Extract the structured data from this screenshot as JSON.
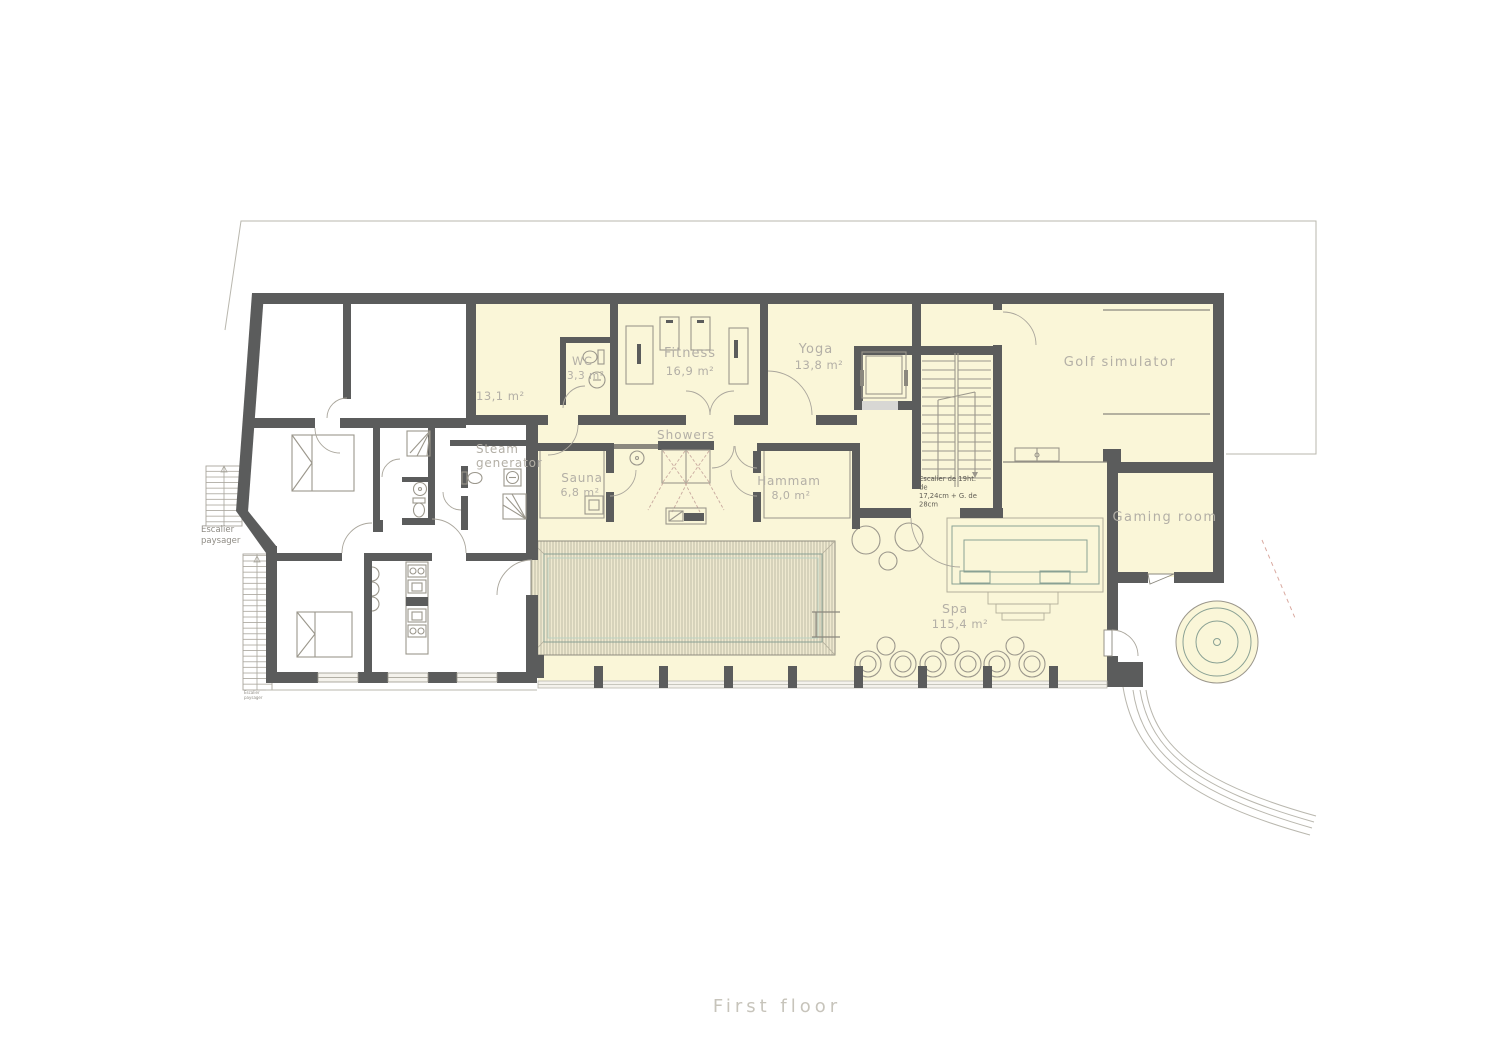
{
  "title": "First floor",
  "rooms": {
    "room131": {
      "area": "13,1 m²"
    },
    "wc": {
      "name": "WC",
      "area": "3,3 m²"
    },
    "fitness": {
      "name": "Fitness",
      "area": "16,9 m²"
    },
    "yoga": {
      "name": "Yoga",
      "area": "13,8 m²"
    },
    "golf": {
      "name": "Golf simulator"
    },
    "showers": {
      "name": "Showers"
    },
    "sauna": {
      "name": "Sauna",
      "area": "6,8 m²"
    },
    "hammam": {
      "name": "Hammam",
      "area": "8,0 m²"
    },
    "steam_generator": {
      "line1": "Steam",
      "line2": "generator"
    },
    "gaming": {
      "name": "Gaming room"
    },
    "spa": {
      "name": "Spa",
      "area": "115,4 m²"
    }
  },
  "annotations": {
    "stair_note_line1": "Escalier de 19ht.",
    "stair_note_line2": "de",
    "stair_note_line3": "17,24cm + G. de",
    "stair_note_line4": "28cm",
    "landscape_stair": {
      "line1": "Escalier",
      "line2": "paysager"
    },
    "landscape_stair_small": {
      "line1": "Escalier",
      "line2": "paysager"
    }
  },
  "colors": {
    "wall": "#5b5c5c",
    "room_fill": "#faf6d8",
    "pool_water": "#cfe8da",
    "pool_deck": "#efe9d0",
    "label_text": "#b3afa6",
    "note_text": "#5f5c54",
    "title_text": "#c7c4bb"
  }
}
